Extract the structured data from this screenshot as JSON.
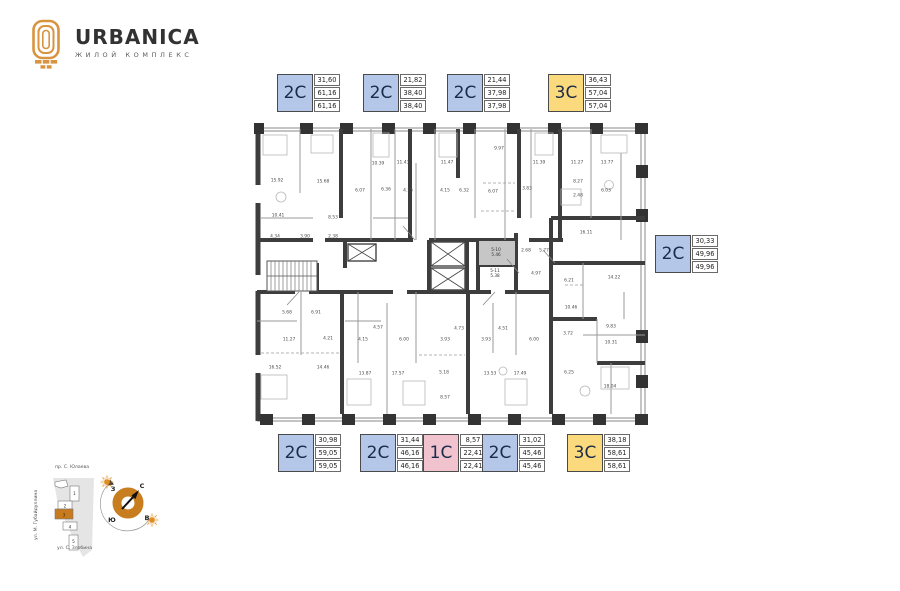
{
  "logo": {
    "title": "URBANICA",
    "subtitle": "ЖИЛОЙ КОМПЛЕКС"
  },
  "colors": {
    "accent_orange": "#cf831f",
    "badge_blue": "#b5c7e8",
    "badge_yellow": "#fbda7e",
    "badge_pink": "#f0c3cf",
    "wall_dark": "#3d3d3d"
  },
  "badges": [
    {
      "id": "top-1",
      "type": "2С",
      "color": "blue",
      "values": [
        "31,60",
        "61,16",
        "61,16"
      ],
      "x": 277,
      "y": 74
    },
    {
      "id": "top-2",
      "type": "2С",
      "color": "blue",
      "values": [
        "21,82",
        "38,40",
        "38,40"
      ],
      "x": 363,
      "y": 74
    },
    {
      "id": "top-3",
      "type": "2С",
      "color": "blue",
      "values": [
        "21,44",
        "37,98",
        "37,98"
      ],
      "x": 447,
      "y": 74
    },
    {
      "id": "top-4",
      "type": "3С",
      "color": "yellow",
      "values": [
        "36,43",
        "57,04",
        "57,04"
      ],
      "x": 548,
      "y": 74
    },
    {
      "id": "right-1",
      "type": "2С",
      "color": "blue",
      "values": [
        "30,33",
        "49,96",
        "49,96"
      ],
      "x": 655,
      "y": 235
    },
    {
      "id": "bottom-1",
      "type": "2С",
      "color": "blue",
      "values": [
        "30,98",
        "59,05",
        "59,05"
      ],
      "x": 278,
      "y": 434
    },
    {
      "id": "bottom-2",
      "type": "2С",
      "color": "blue",
      "values": [
        "31,44",
        "46,16",
        "46,16"
      ],
      "x": 360,
      "y": 434
    },
    {
      "id": "bottom-3",
      "type": "1С",
      "color": "pink",
      "values": [
        "8,57",
        "22,41",
        "22,41"
      ],
      "x": 423,
      "y": 434
    },
    {
      "id": "bottom-4",
      "type": "2С",
      "color": "blue",
      "values": [
        "31,02",
        "45,46",
        "45,46"
      ],
      "x": 482,
      "y": 434
    },
    {
      "id": "bottom-5",
      "type": "3С",
      "color": "yellow",
      "values": [
        "38,18",
        "58,61",
        "58,61"
      ],
      "x": 567,
      "y": 434
    }
  ],
  "plan": {
    "rooms": [
      {
        "t": "15.92",
        "x": 24,
        "y": 58
      },
      {
        "t": "15.68",
        "x": 70,
        "y": 59
      },
      {
        "t": "10.39",
        "x": 125,
        "y": 41
      },
      {
        "t": "11.43",
        "x": 150,
        "y": 40
      },
      {
        "t": "11.47",
        "x": 194,
        "y": 40
      },
      {
        "t": "9.97",
        "x": 246,
        "y": 26
      },
      {
        "t": "11.39",
        "x": 286,
        "y": 40
      },
      {
        "t": "11.27",
        "x": 324,
        "y": 40
      },
      {
        "t": "13.77",
        "x": 354,
        "y": 40
      },
      {
        "t": "6.07",
        "x": 107,
        "y": 68
      },
      {
        "t": "6.36",
        "x": 133,
        "y": 67
      },
      {
        "t": "4.15",
        "x": 155,
        "y": 68
      },
      {
        "t": "4.15",
        "x": 192,
        "y": 68
      },
      {
        "t": "6.32",
        "x": 211,
        "y": 68
      },
      {
        "t": "6.07",
        "x": 240,
        "y": 69
      },
      {
        "t": "3.83",
        "x": 274,
        "y": 66
      },
      {
        "t": "8.27",
        "x": 325,
        "y": 59
      },
      {
        "t": "6.03",
        "x": 353,
        "y": 68
      },
      {
        "t": "10.41",
        "x": 25,
        "y": 93
      },
      {
        "t": "8.53",
        "x": 80,
        "y": 95
      },
      {
        "t": "4.34",
        "x": 22,
        "y": 114
      },
      {
        "t": "3.90",
        "x": 52,
        "y": 114
      },
      {
        "t": "2.38",
        "x": 80,
        "y": 114
      },
      {
        "t": "2.48",
        "x": 325,
        "y": 73
      },
      {
        "t": "16.11",
        "x": 333,
        "y": 110
      },
      {
        "t": "2.68",
        "x": 273,
        "y": 128
      },
      {
        "t": "5.77",
        "x": 291,
        "y": 128
      },
      {
        "t": "4.97",
        "x": 283,
        "y": 151
      },
      {
        "t": "6.21",
        "x": 316,
        "y": 158
      },
      {
        "t": "14.22",
        "x": 361,
        "y": 155
      },
      {
        "t": "10.46",
        "x": 318,
        "y": 185
      },
      {
        "t": "3.72",
        "x": 315,
        "y": 211
      },
      {
        "t": "9.83",
        "x": 358,
        "y": 204
      },
      {
        "t": "10.31",
        "x": 358,
        "y": 220
      },
      {
        "t": "5.68",
        "x": 34,
        "y": 190
      },
      {
        "t": "6.91",
        "x": 63,
        "y": 190
      },
      {
        "t": "11.27",
        "x": 36,
        "y": 217
      },
      {
        "t": "4.21",
        "x": 75,
        "y": 216
      },
      {
        "t": "4.15",
        "x": 110,
        "y": 217
      },
      {
        "t": "4.57",
        "x": 125,
        "y": 205
      },
      {
        "t": "6.00",
        "x": 151,
        "y": 217
      },
      {
        "t": "16.52",
        "x": 22,
        "y": 245
      },
      {
        "t": "14.46",
        "x": 70,
        "y": 245
      },
      {
        "t": "13.87",
        "x": 112,
        "y": 251
      },
      {
        "t": "17.57",
        "x": 145,
        "y": 251
      },
      {
        "t": "4.73",
        "x": 206,
        "y": 206
      },
      {
        "t": "4.51",
        "x": 250,
        "y": 206
      },
      {
        "t": "3.93",
        "x": 192,
        "y": 217
      },
      {
        "t": "3.93",
        "x": 233,
        "y": 217
      },
      {
        "t": "6.00",
        "x": 281,
        "y": 217
      },
      {
        "t": "5.18",
        "x": 191,
        "y": 250
      },
      {
        "t": "13.53",
        "x": 237,
        "y": 251
      },
      {
        "t": "17.49",
        "x": 267,
        "y": 251
      },
      {
        "t": "6.25",
        "x": 316,
        "y": 250
      },
      {
        "t": "8.57",
        "x": 192,
        "y": 275
      },
      {
        "t": "18.04",
        "x": 357,
        "y": 264
      }
    ],
    "tech_rooms": [
      {
        "l1": "5-10",
        "l2": "5.46",
        "x": 243,
        "y": 130
      },
      {
        "l1": "5-11",
        "l2": "5.38",
        "x": 242,
        "y": 151
      }
    ]
  },
  "map": {
    "street_top": "пр. С. Юлаева",
    "street_left": "ул. М. Губайдуллина",
    "street_bottom": "ул. С. Злобина",
    "buildings": [
      "1",
      "2",
      "3",
      "4",
      "5"
    ],
    "highlighted_building": "3"
  },
  "compass": {
    "n": "С",
    "s": "Ю",
    "w": "З",
    "e": "В"
  }
}
